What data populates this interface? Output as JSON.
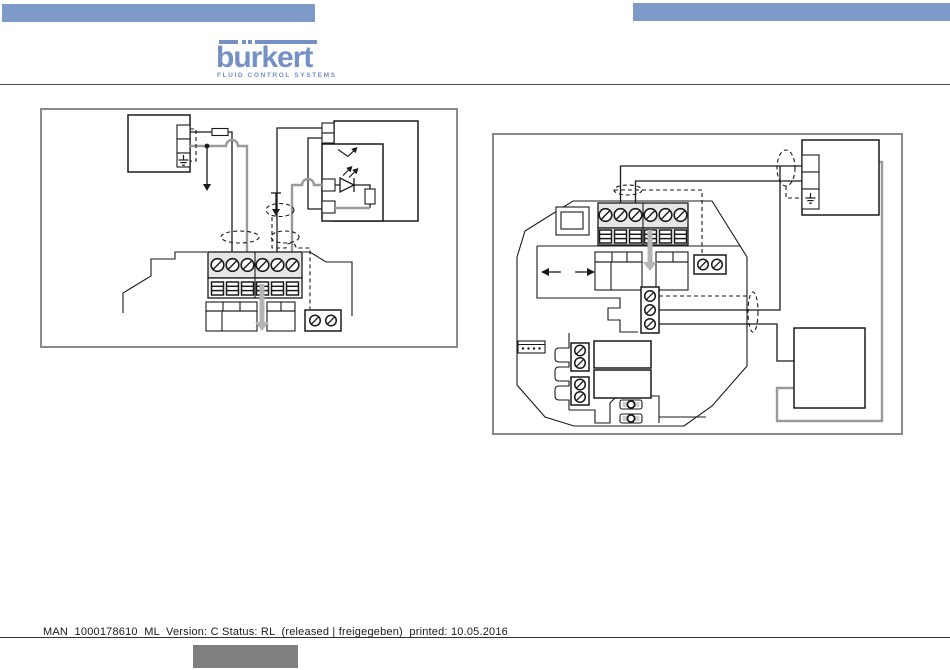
{
  "header": {
    "wordmark": "burkert",
    "tagline": "FLUID CONTROL SYSTEMS"
  },
  "footer": {
    "line_text": "MAN  1000178610  ML  Version: C Status: RL  (released | freigegeben)  printed: 10.05.2016"
  },
  "colors": {
    "header_bar_blue": "#7E9AC8",
    "logo_blue": "#7590C4",
    "wire_gray": "#9a9a9a",
    "soft_arrow_gray": "#b5b5b5",
    "diagram_frame_gray": "#8a8a8a",
    "footer_box_gray": "#7f7f7f",
    "ink": "#1a1a1a"
  }
}
